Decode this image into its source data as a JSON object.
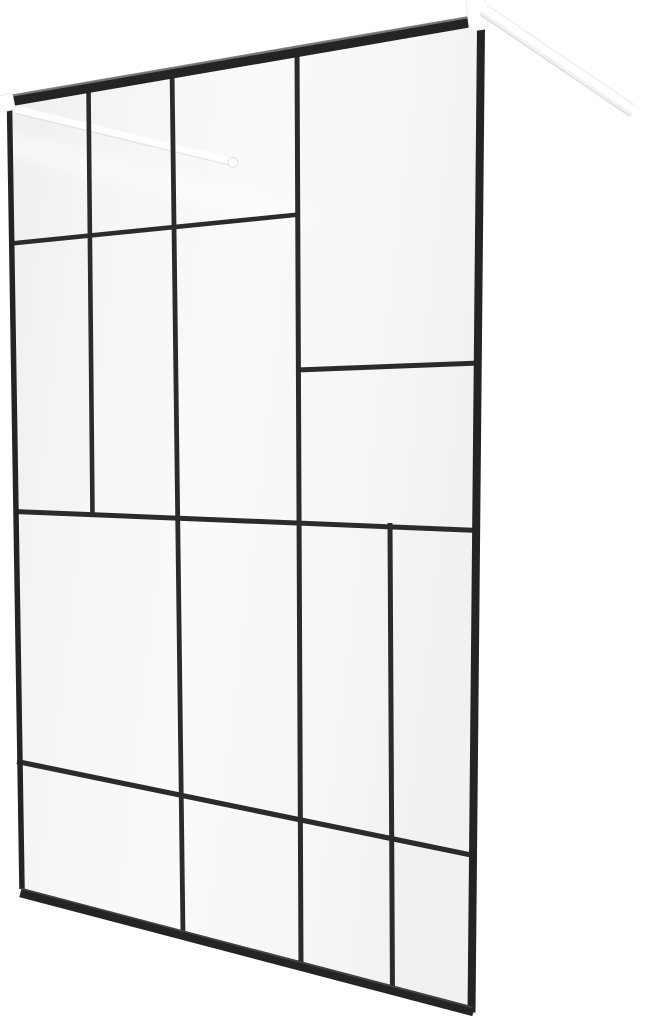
{
  "image": {
    "description": "Product photo of a walk-in shower glass screen with a black frame, an abstract black grid pattern on the glass, and white wall-mount support arms",
    "background_color": "#ffffff"
  },
  "scene": {
    "canvas": {
      "width": 646,
      "height": 1024
    },
    "colors": {
      "frame": "#242424",
      "grid": "#2b2b2b",
      "white": "#ffffff"
    },
    "glass": {
      "points": "11,103 483.5,21.5 475.5,1015 19,888",
      "gradient_stops": [
        {
          "offset": "0%",
          "color": "#eeeeee"
        },
        {
          "offset": "18%",
          "color": "#f4f4f4"
        },
        {
          "offset": "50%",
          "color": "#fafafa"
        },
        {
          "offset": "80%",
          "color": "#f6f6f6"
        },
        {
          "offset": "100%",
          "color": "#f1f1f1"
        }
      ]
    },
    "reflection": {
      "from": [
        -5,
        140
      ],
      "to": [
        300,
        218
      ],
      "width": 24,
      "color": "#ffffff",
      "opacity": 0.45,
      "cap": "round",
      "blur": true
    },
    "back_arm": {
      "parts": [
        {
          "type": "line",
          "name": "support-arm-left-body",
          "from": [
            15,
            109
          ],
          "to": [
            231,
            161.5
          ],
          "width": 7.5,
          "color": "#ffffff",
          "opacity": 0.85,
          "cap": "round"
        },
        {
          "type": "line",
          "name": "support-arm-left-shadow-edge",
          "from": [
            16,
            113.5
          ],
          "to": [
            231.5,
            165.5
          ],
          "width": 1.4,
          "color": "#dcdcdc",
          "opacity": 0.7,
          "cap": "round"
        },
        {
          "type": "circle",
          "name": "support-arm-left-anchor-cap",
          "cx": 233,
          "cy": 162.5,
          "r": 5,
          "fill": "#fdfdfd",
          "stroke": "#e3e3e3",
          "stroke_width": 1
        }
      ]
    },
    "grid": {
      "verticals": [
        {
          "name": "grid-line-v1",
          "from": [
            88.5,
            88
          ],
          "to": [
            92.5,
            516
          ],
          "width": 4.6
        },
        {
          "name": "grid-line-v2",
          "from": [
            172,
            68
          ],
          "to": [
            183,
            935
          ],
          "width": 4.8
        },
        {
          "name": "grid-line-v3",
          "from": [
            297,
            46
          ],
          "to": [
            301,
            969
          ],
          "width": 5
        },
        {
          "name": "grid-line-v4",
          "from": [
            390,
            523
          ],
          "to": [
            392.5,
            994
          ],
          "width": 5
        }
      ],
      "horizontals": [
        {
          "name": "grid-line-h1",
          "from": [
            11,
            243.5
          ],
          "to": [
            299,
            214.5
          ],
          "width": 4.6
        },
        {
          "name": "grid-line-h2",
          "from": [
            297,
            370
          ],
          "to": [
            480,
            363
          ],
          "width": 5
        },
        {
          "name": "grid-line-h3",
          "from": [
            14,
            511.5
          ],
          "to": [
            479,
            530.5
          ],
          "width": 5
        },
        {
          "name": "grid-line-h4",
          "from": [
            17,
            761.5
          ],
          "to": [
            476,
            856
          ],
          "width": 5.2
        }
      ]
    },
    "frame": {
      "edges": [
        {
          "name": "frame-top-bar",
          "from": [
            9.5,
            101
          ],
          "to": [
            484,
            19.5
          ],
          "width": 11
        },
        {
          "name": "frame-left-edge",
          "from": [
            9.5,
            105.5
          ],
          "to": [
            22,
            889
          ],
          "width": 5.5
        },
        {
          "name": "frame-right-edge",
          "from": [
            481,
            27
          ],
          "to": [
            471.5,
            1012.5
          ],
          "width": 8
        },
        {
          "name": "frame-bottom-bar",
          "from": [
            20.5,
            892.5
          ],
          "to": [
            473.5,
            1011.5
          ],
          "width": 9.5
        }
      ],
      "highlights": [
        {
          "name": "frame-top-bar-highlight",
          "from": [
            9.5,
            96
          ],
          "to": [
            484,
            14.5
          ],
          "width": 2.4,
          "color": "#7d7d7d",
          "opacity": 0.9
        },
        {
          "name": "frame-bottom-bar-highlight",
          "from": [
            21,
            888.5
          ],
          "to": [
            472.5,
            1007.5
          ],
          "width": 1.6,
          "color": "#5a5a5a",
          "opacity": 0.6
        }
      ]
    },
    "hardware": {
      "brackets": [
        {
          "name": "wall-bracket-left",
          "cx": 2,
          "cy": 103.5,
          "w": 24,
          "h": 16.5,
          "angle": -11,
          "rx": 2.5,
          "fill": "#ffffff",
          "stroke": "#ebebeb"
        },
        {
          "name": "wall-bracket-right",
          "cx": 477,
          "cy": 13.5,
          "w": 19,
          "h": 33,
          "angle": -7,
          "rx": 2.5,
          "fill": "#ffffff",
          "stroke": "#ececec"
        }
      ],
      "right_arm_parts": [
        {
          "type": "line",
          "name": "support-arm-right-body",
          "from": [
            484,
            10
          ],
          "to": [
            633,
            111
          ],
          "width": 13.5,
          "color": "#ffffff",
          "opacity": 1,
          "cap": "round"
        },
        {
          "type": "line",
          "name": "support-arm-right-top-edge",
          "from": [
            487,
            5
          ],
          "to": [
            636,
            106
          ],
          "width": 1.2,
          "color": "#ececec",
          "opacity": 0.9,
          "cap": "round"
        },
        {
          "type": "line",
          "name": "support-arm-right-shading",
          "from": [
            481.8,
            13.3
          ],
          "to": [
            630.8,
            114.3
          ],
          "width": 3,
          "color": "#f2f2f2",
          "opacity": 1,
          "cap": "round"
        },
        {
          "type": "line",
          "name": "support-arm-right-shadow-edge",
          "from": [
            480.6,
            15
          ],
          "to": [
            629.6,
            116
          ],
          "width": 1.6,
          "color": "#dadada",
          "opacity": 0.9,
          "cap": "round"
        }
      ]
    }
  }
}
